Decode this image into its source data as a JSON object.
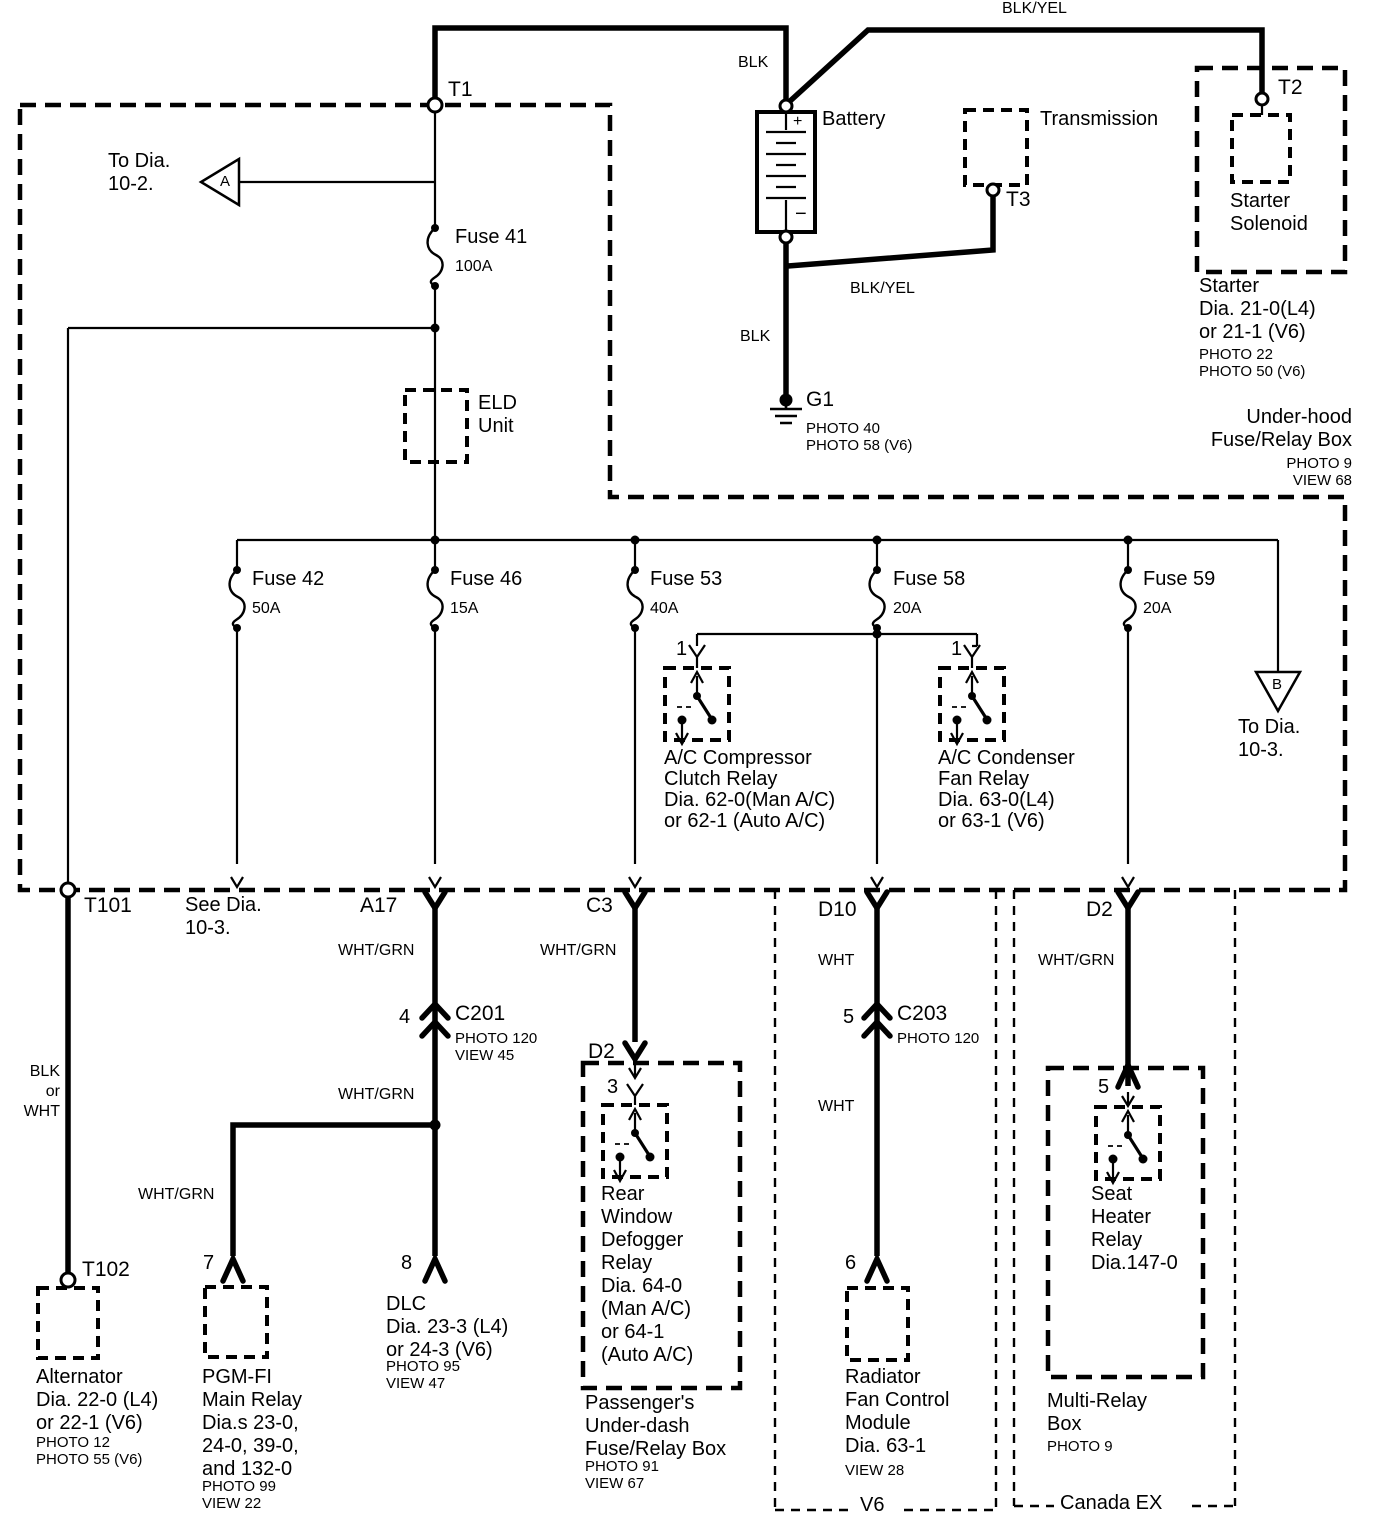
{
  "colors": {
    "line": "#000000",
    "background": "#ffffff"
  },
  "top": {
    "blk_yel_top": "BLK/YEL",
    "t1": "T1",
    "blk_battery": "BLK",
    "battery": "Battery",
    "battery_plus": "+",
    "battery_minus": "−",
    "transmission": "Transmission",
    "t3": "T3",
    "t2": "T2",
    "blk_yel_trans": "BLK/YEL",
    "blk_ground": "BLK",
    "g1": "G1",
    "g1_notes": "PHOTO 40\nPHOTO 58 (V6)",
    "starter_solenoid": "Starter\nSolenoid",
    "starter_ref": "Starter\nDia. 21-0(L4)\nor 21-1 (V6)",
    "starter_notes": "PHOTO 22\nPHOTO 50 (V6)",
    "underhood_box": "Under-hood\nFuse/Relay Box",
    "underhood_notes": "PHOTO 9\nVIEW 68",
    "to_dia_a": "To Dia.\n10-2.",
    "conn_a": "A"
  },
  "fuses": {
    "eld": "ELD\nUnit",
    "f41": {
      "name": "Fuse 41",
      "amps": "100A"
    },
    "f42": {
      "name": "Fuse 42",
      "amps": "50A"
    },
    "f46": {
      "name": "Fuse 46",
      "amps": "15A"
    },
    "f53": {
      "name": "Fuse 53",
      "amps": "40A"
    },
    "f58": {
      "name": "Fuse 58",
      "amps": "20A"
    },
    "f59": {
      "name": "Fuse 59",
      "amps": "20A"
    }
  },
  "mid": {
    "comp_pin": "1",
    "comp_relay": "A/C Compressor\nClutch Relay\nDia. 62-0(Man A/C)\nor 62-1 (Auto A/C)",
    "cond_pin": "1",
    "cond_relay": "A/C Condenser\nFan Relay\nDia. 63-0(L4)\nor 63-1 (V6)",
    "conn_b": "B",
    "to_dia_b": "To Dia.\n10-3."
  },
  "bottom": {
    "t101": "T101",
    "see_dia": "See Dia.\n10-3.",
    "a17": "A17",
    "c3": "C3",
    "d10": "D10",
    "d2_right": "D2",
    "wht_grn_a17": "WHT/GRN",
    "wht_grn_c3": "WHT/GRN",
    "wht_d10": "WHT",
    "wht_grn_d2": "WHT/GRN",
    "c201_pin": "4",
    "c201": "C201",
    "c201_notes": "PHOTO 120\nVIEW 45",
    "wht_grn_a17b": "WHT/GRN",
    "c203_pin": "5",
    "c203": "C203",
    "c203_notes": "PHOTO 120",
    "wht_d10b": "WHT",
    "wht_grn_pgm": "WHT/GRN",
    "blk_or_wht": "BLK\nor\nWHT",
    "t102": "T102",
    "alternator": "Alternator\nDia. 22-0 (L4)\nor 22-1 (V6)",
    "alternator_notes": "PHOTO 12\nPHOTO 55 (V6)",
    "pgm_pin": "7",
    "pgm": "PGM-FI\nMain Relay\nDia.s 23-0,\n24-0, 39-0,\nand 132-0",
    "pgm_notes": "PHOTO 99\nVIEW 22",
    "dlc_pin": "8",
    "dlc": "DLC\nDia. 23-3 (L4)\nor 24-3 (V6)",
    "dlc_notes": "PHOTO 95\nVIEW 47",
    "d2_mid": "D2",
    "defog_pin": "3",
    "defog": "Rear\nWindow\nDefogger\nRelay\nDia. 64-0\n(Man A/C)\nor 64-1\n(Auto A/C)",
    "passenger": "Passenger's\nUnder-dash\nFuse/Relay Box",
    "passenger_notes": "PHOTO 91\nVIEW 67",
    "rad_pin": "6",
    "radiator": "Radiator\nFan Control\nModule\nDia. 63-1",
    "radiator_notes": "VIEW 28",
    "v6": "V6",
    "seat_pin": "5",
    "seat": "Seat\nHeater\nRelay\nDia.147-0",
    "multi": "Multi-Relay\nBox",
    "multi_notes": "PHOTO 9",
    "canada": "Canada EX"
  }
}
